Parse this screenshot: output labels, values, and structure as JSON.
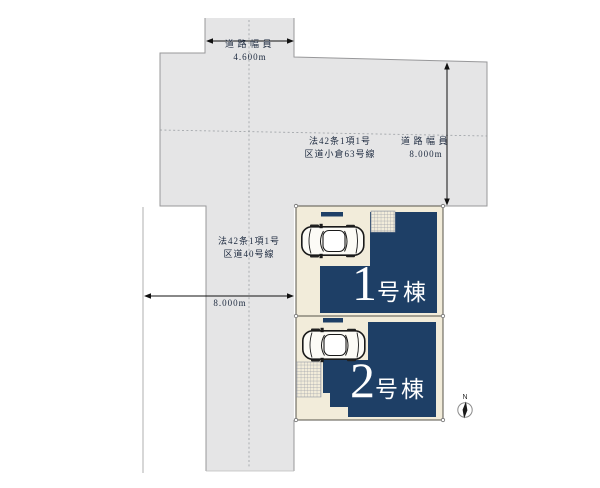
{
  "diagram_type": "residential-site-plan",
  "colors": {
    "road_gray": "#e5e5e6",
    "road_edge_gray": "#98989a",
    "lot_cream": "#f2ecda",
    "lot_edge": "#57534a",
    "building_navy": "#1e3f66",
    "dimension_black": "#111111",
    "label_text": "#1e2b40",
    "hatch_line": "#979ca6"
  },
  "roads": {
    "branch_top": {
      "width_label": "道路幅員",
      "width_value": "4.600m"
    },
    "main": {
      "law_line": "法42条1項1号",
      "name": "区道小倉63号線",
      "width_label": "道路幅員",
      "width_value": "8.000m"
    },
    "left": {
      "law_line": "法42条1項1号",
      "name": "区道40号線",
      "width_value": "8.000m"
    }
  },
  "lots": [
    {
      "building_number": "1",
      "building_suffix": "号棟"
    },
    {
      "building_number": "2",
      "building_suffix": "号棟"
    }
  ],
  "compass": {
    "label": "N"
  },
  "icons": {
    "car": "car-top-view-icon",
    "compass": "north-compass-icon",
    "hatch": "hatched-terrace-area"
  }
}
